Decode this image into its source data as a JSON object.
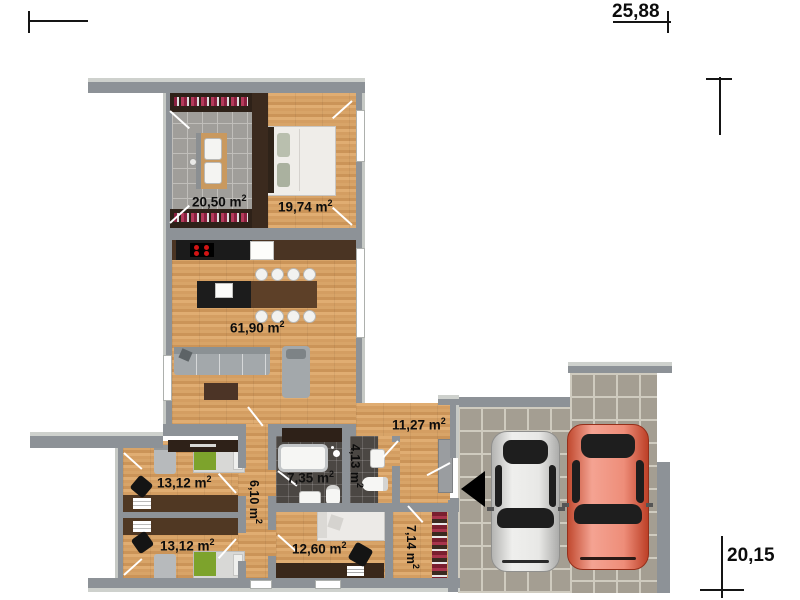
{
  "annotations": {
    "width_total": "25,88",
    "height_total": "20,15"
  },
  "rooms": {
    "dressing": {
      "label": "20,50 m",
      "sup": "2"
    },
    "bedroom": {
      "label": "19,74 m",
      "sup": "2"
    },
    "living": {
      "label": "61,90 m",
      "sup": "2"
    },
    "hall": {
      "label": "11,27 m",
      "sup": "2"
    },
    "kid1": {
      "label": "13,12 m",
      "sup": "2"
    },
    "kid2": {
      "label": "13,12 m",
      "sup": "2"
    },
    "bath": {
      "label": "7,35 m",
      "sup": "2"
    },
    "wc": {
      "label": "4,13 m",
      "sup": "2"
    },
    "corridor": {
      "label": "6,10 m",
      "sup": "2"
    },
    "office": {
      "label": "12,60 m",
      "sup": "2"
    },
    "pantry": {
      "label": "7,14 m",
      "sup": "2"
    }
  },
  "colors": {
    "wall": "#8d9297",
    "wood_floor": "#d8a365",
    "tile_light": "#a09e9a",
    "tile_dark": "#4b4743",
    "garage_tile": "#a49e92",
    "furniture_dark_brown": "#2e2118",
    "sofa_gray": "#a3a8ab",
    "bed_green": "#7da32c",
    "car_white": "#e3e3e1",
    "car_red": "#ee8d79"
  }
}
